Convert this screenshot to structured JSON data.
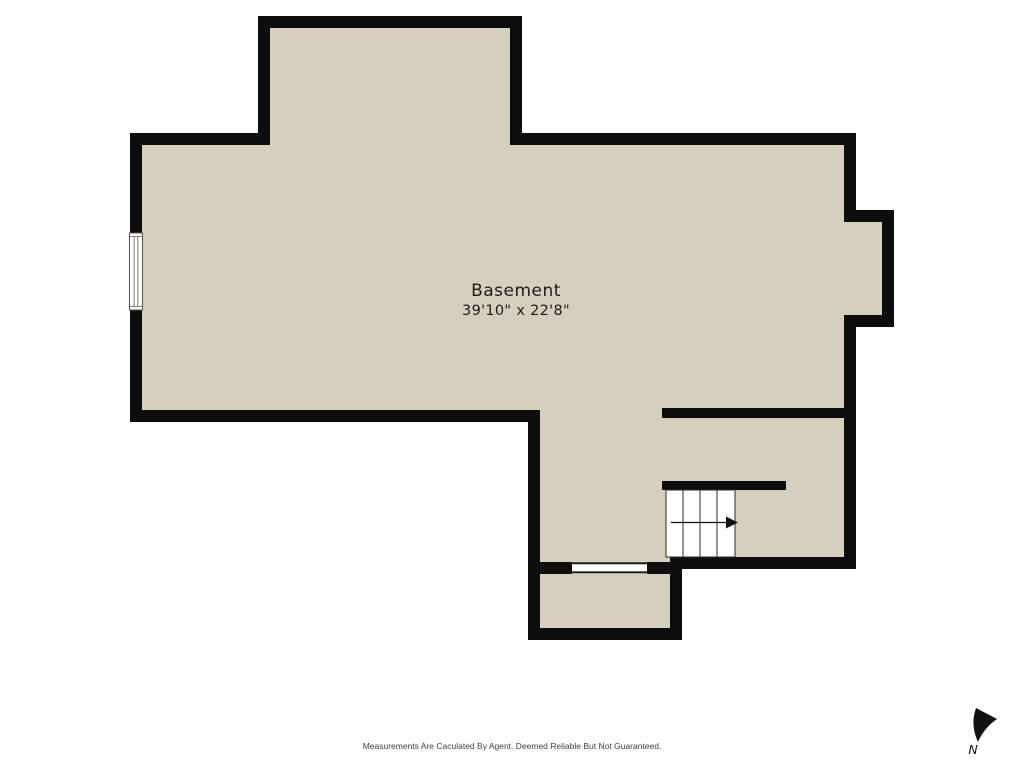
{
  "room": {
    "name": "Basement",
    "dimensions": "39'10\" x 22'8\""
  },
  "compass": {
    "label": "N",
    "icon": "north-arrow"
  },
  "footer": {
    "disclaimer": "Measurements Are Caculated By Agent. Deemed Reliable But Not Guaranteed."
  },
  "colors": {
    "background": "#ffffff",
    "floor_fill": "#d7cfbe",
    "wall": "#0d0d0d",
    "stair_line": "#2b2b2b",
    "arrow": "#111111"
  }
}
